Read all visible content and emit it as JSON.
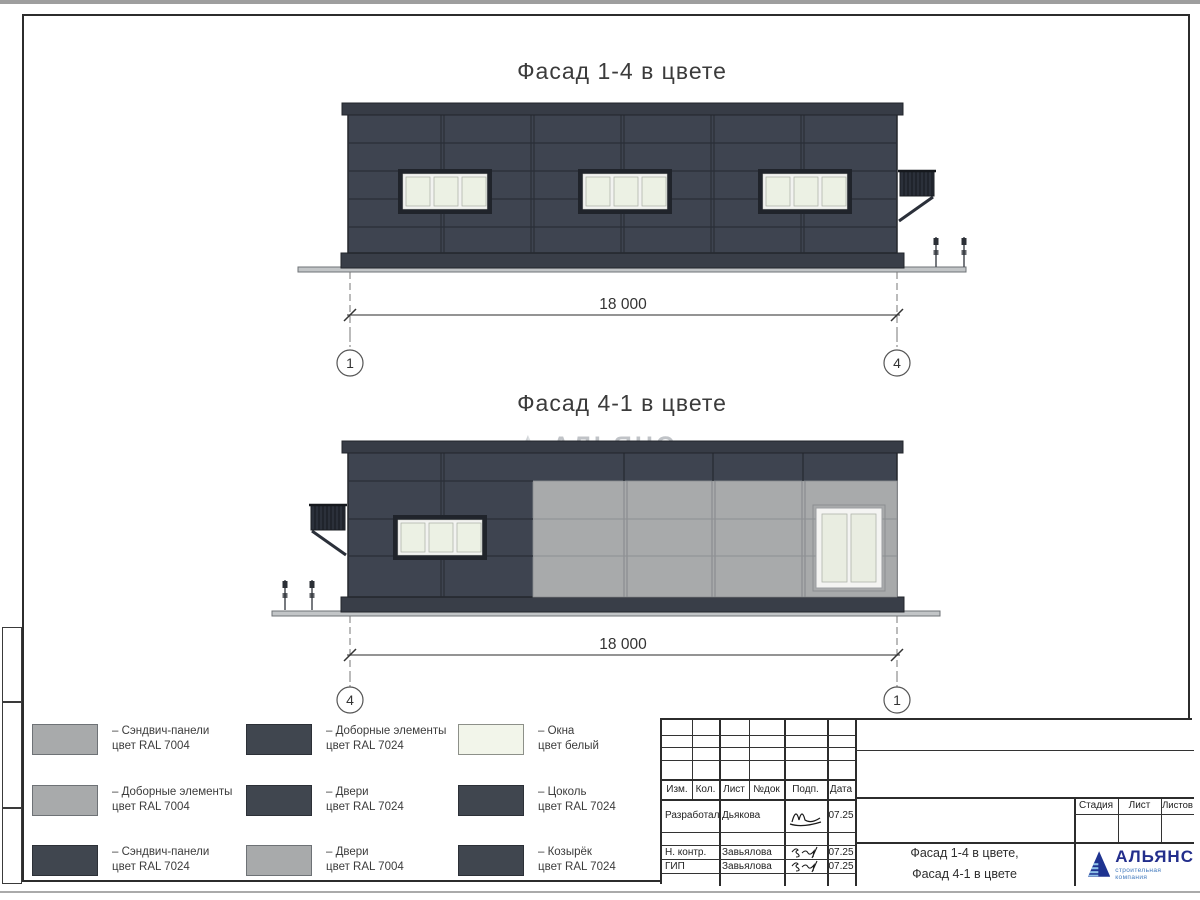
{
  "titles": {
    "facade14": "Фасад 1-4 в цвете",
    "facade41": "Фасад 4-1 в цвете"
  },
  "dimensions": {
    "facade14": "18 000",
    "facade41": "18 000"
  },
  "axes": {
    "facade14_left": "1",
    "facade14_right": "4",
    "facade41_left": "4",
    "facade41_right": "1"
  },
  "watermark": {
    "title": "АЛЬЯНС",
    "subtitle": "строительная компания"
  },
  "legend": [
    {
      "swatch": "ral7004",
      "line1": "– Сэндвич-панели",
      "line2": "цвет RAL 7004"
    },
    {
      "swatch": "ral7004",
      "line1": "– Доборные элементы",
      "line2": "цвет RAL 7004"
    },
    {
      "swatch": "ral7024",
      "line1": "– Сэндвич-панели",
      "line2": "цвет RAL 7024"
    },
    {
      "swatch": "ral7024",
      "line1": "– Доборные элементы",
      "line2": "цвет RAL 7024"
    },
    {
      "swatch": "ral7024",
      "line1": "– Двери",
      "line2": "цвет RAL 7024"
    },
    {
      "swatch": "ral7004",
      "line1": "– Двери",
      "line2": "цвет RAL 7004"
    },
    {
      "swatch": "white",
      "line1": "– Окна",
      "line2": "цвет белый"
    },
    {
      "swatch": "ral7024",
      "line1": "– Цоколь",
      "line2": "цвет RAL 7024"
    },
    {
      "swatch": "ral7024",
      "line1": "– Козырёк",
      "line2": "цвет RAL 7024"
    }
  ],
  "titleblock": {
    "header": [
      "Изм.",
      "Кол.",
      "Лист",
      "№док",
      "Подп.",
      "Дата"
    ],
    "rows": [
      {
        "role": "Разработал",
        "name": "Дьякова",
        "date": "07.25"
      },
      {
        "role": "Н. контр.",
        "name": "Завьялова",
        "date": "07.25"
      },
      {
        "role": "ГИП",
        "name": "Завьялова",
        "date": "07.25"
      }
    ],
    "stage_cols": [
      "Стадия",
      "Лист",
      "Листов"
    ],
    "doc_title_line1": "Фасад 1-4 в цвете,",
    "doc_title_line2": "Фасад 4-1 в цвете",
    "logo_title": "АЛЬЯНС",
    "logo_subtitle": "строительная компания"
  },
  "colors": {
    "ral7024": "#3e4450",
    "ral7004": "#a8aaab",
    "window_white": "#f2f5ea",
    "logo_blue": "#1e3390",
    "logo_light_blue": "#8fc1e8"
  }
}
